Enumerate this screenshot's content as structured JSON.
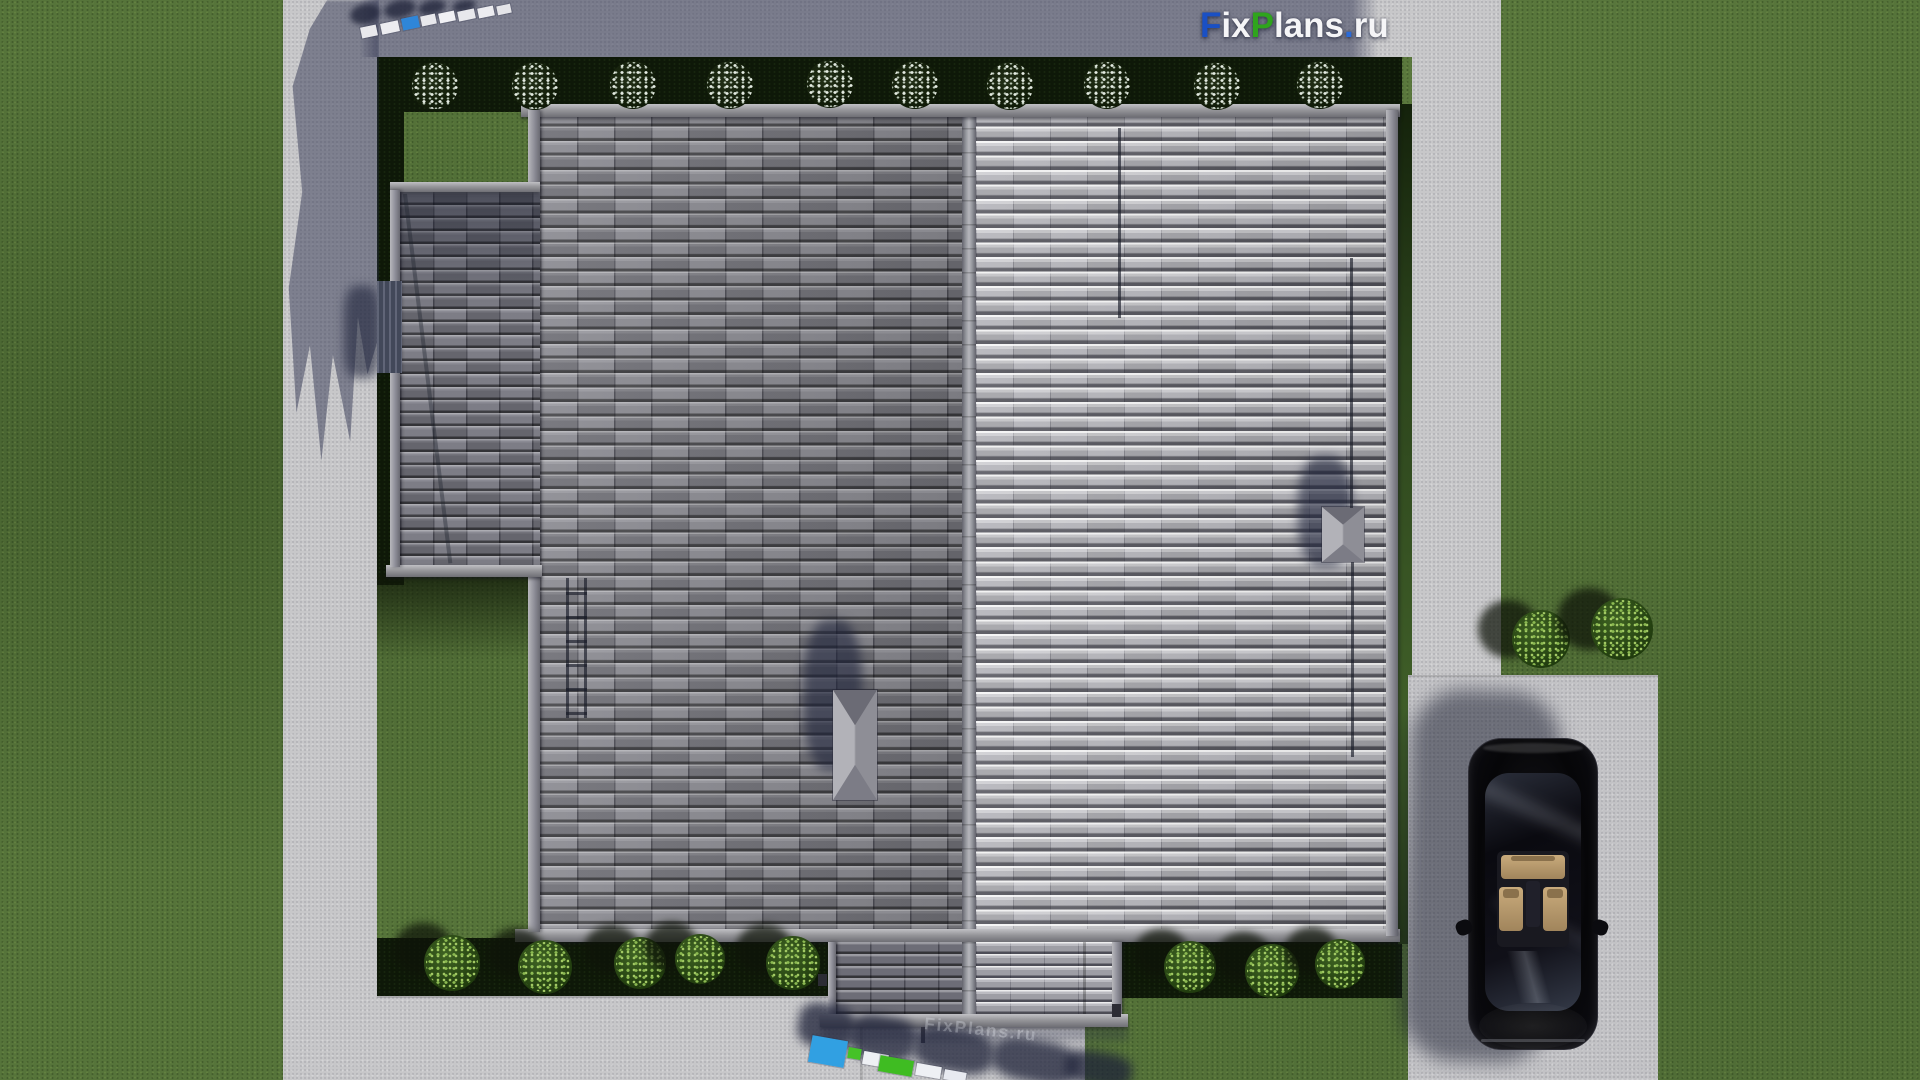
{
  "brand": {
    "logo_text": "FixPlans.ru",
    "logo_parts": [
      {
        "text": "F",
        "color": "#1a50c4"
      },
      {
        "text": "ix",
        "color": "#f5f5f7"
      },
      {
        "text": "P",
        "color": "#2fa41d"
      },
      {
        "text": "lans",
        "color": "#f5f5f7"
      },
      {
        "text": ".",
        "color": "#2b6bd8"
      },
      {
        "text": "ru",
        "color": "#f5f5f7"
      }
    ],
    "ghost_text": "FixPlans.ru"
  },
  "palette": {
    "lawn": "#56743a",
    "lawn_shadow": "#0e1808",
    "concrete": "#c7c7c9",
    "concrete_shadow": "#2c304e",
    "roof_tile_dark": "#55555f",
    "roof_tile_light": "#b4b4ba",
    "roof_ridge": "#8f8f95",
    "chimney_cap": "#9c9ca0",
    "car_body": "#0a0a0e",
    "car_interior": "#c2a276",
    "bush_white_speckle": "#e4ebe2",
    "bush_green": "#6f9c44",
    "watermark_blue": "#31a0e2",
    "watermark_green": "#3fbc22"
  }
}
